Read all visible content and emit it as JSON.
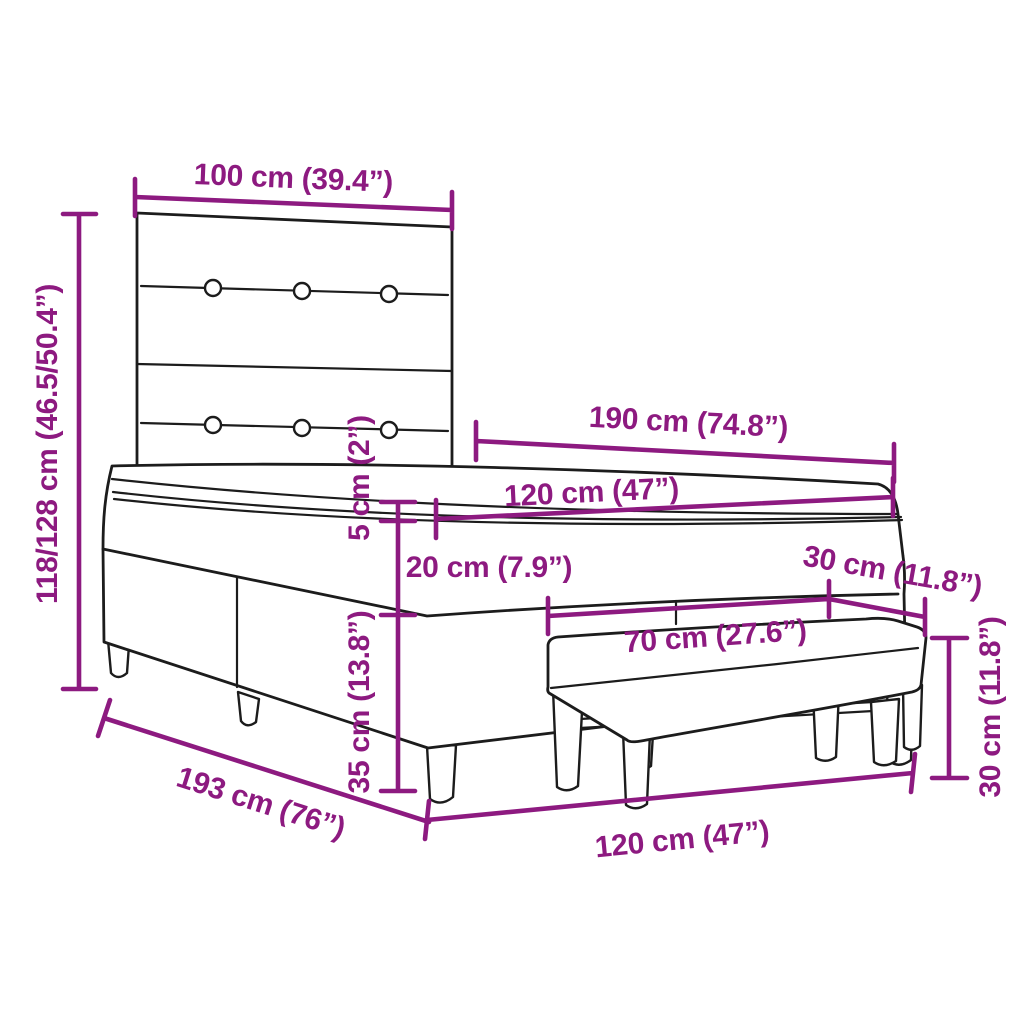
{
  "colors": {
    "accent": "#8d1a80",
    "line": "#1c1c1c",
    "background": "#ffffff"
  },
  "diagram_objects": [
    "box-spring-bed-with-headboard",
    "upholstered-bench"
  ],
  "dimensions": [
    {
      "id": "headboard-width",
      "label": "100 cm (39.4”)"
    },
    {
      "id": "total-height",
      "label": "118/128 cm (46.5/50.4”)"
    },
    {
      "id": "mattress-length",
      "label": "190 cm (74.8”)"
    },
    {
      "id": "mattress-width",
      "label": "120 cm (47”)"
    },
    {
      "id": "topper-thickness",
      "label": "5 cm (2”)"
    },
    {
      "id": "mattress-thickness",
      "label": "20 cm (7.9”)"
    },
    {
      "id": "bench-depth",
      "label": "30 cm (11.8”)"
    },
    {
      "id": "bench-width",
      "label": "70 cm (27.6”)"
    },
    {
      "id": "base-height",
      "label": "35 cm (13.8”)"
    },
    {
      "id": "bench-height",
      "label": "30 cm (11.8”)"
    },
    {
      "id": "bed-length",
      "label": "193 cm (76”)"
    },
    {
      "id": "bed-width",
      "label": "120 cm (47”)"
    }
  ]
}
